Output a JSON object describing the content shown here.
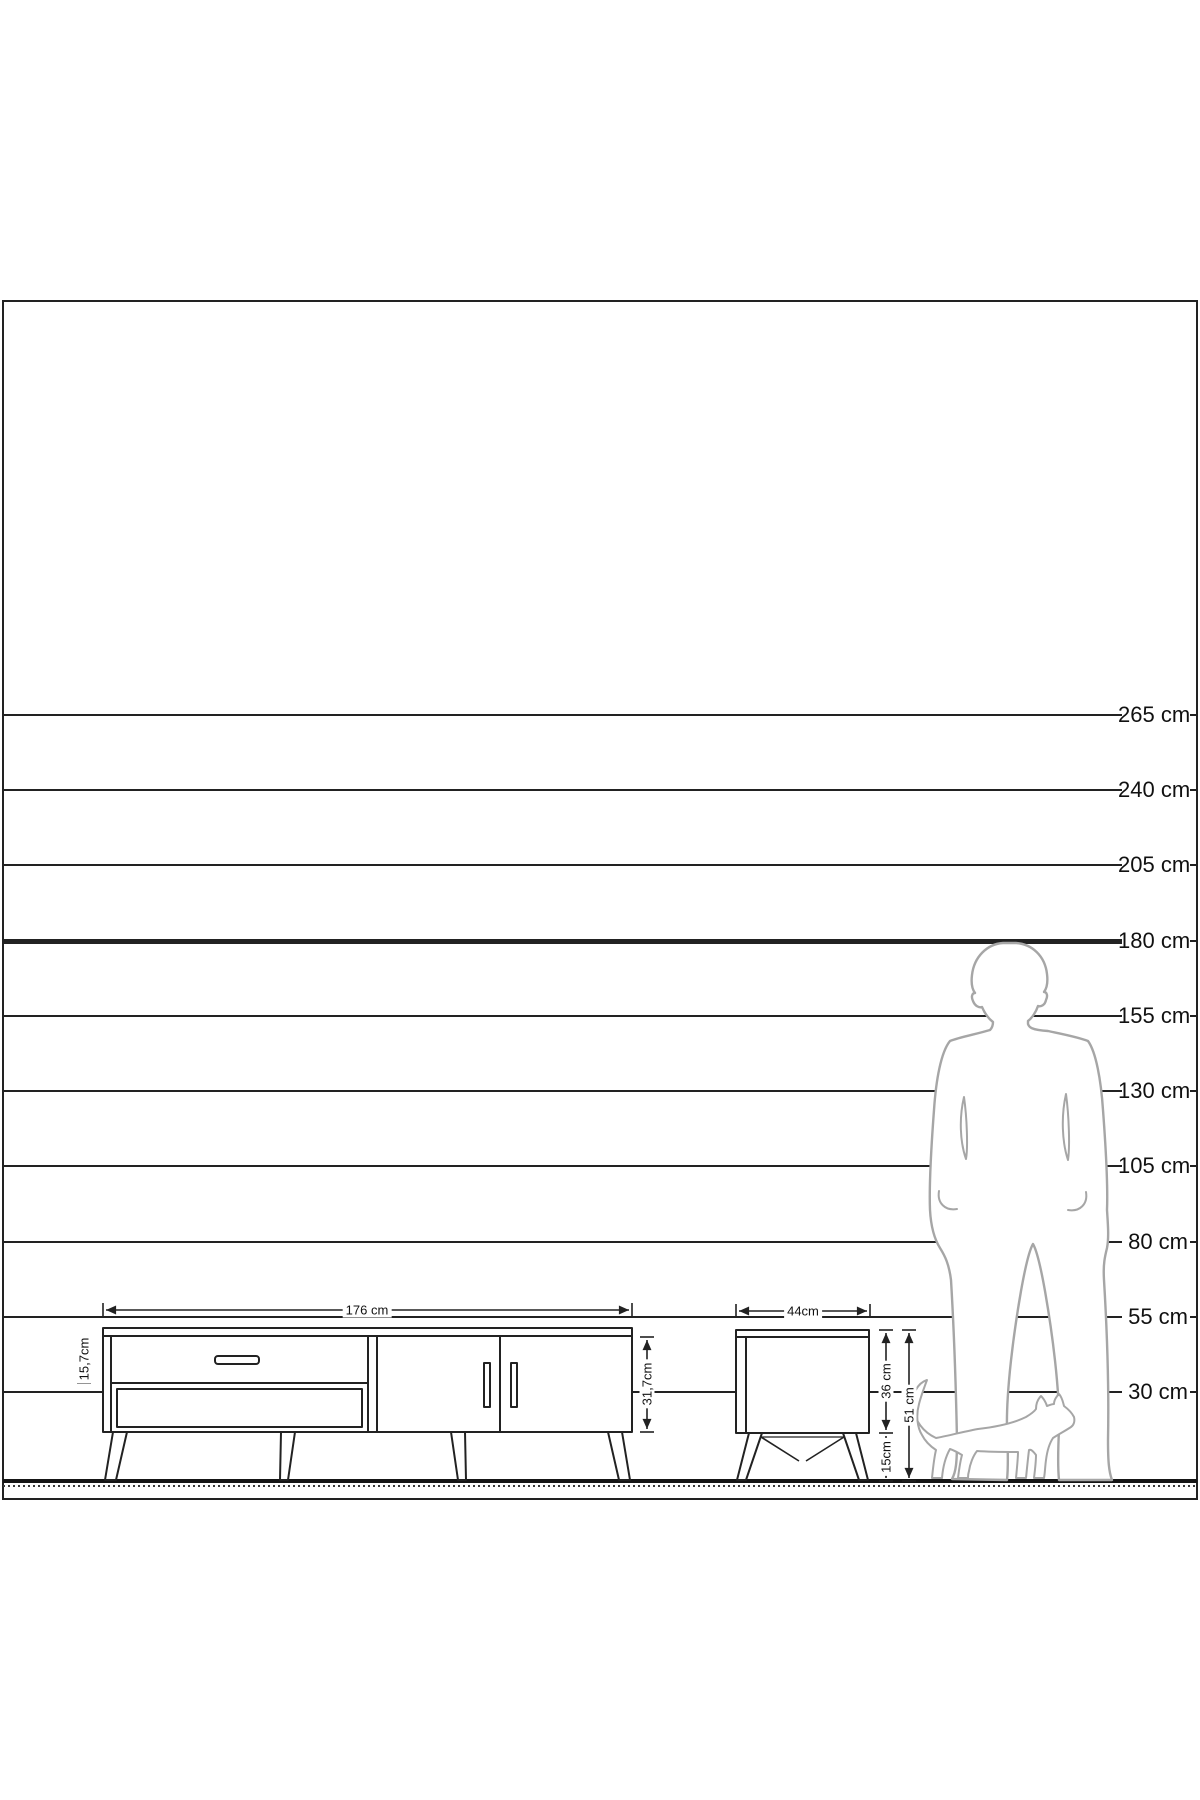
{
  "scale": {
    "labels": [
      "265 cm",
      "240 cm",
      "205 cm",
      "180 cm",
      "155 cm",
      "130 cm",
      "105 cm",
      "80 cm",
      "55 cm",
      "30 cm"
    ],
    "emphasized_label": "180 cm"
  },
  "tv_stand": {
    "width": "176 cm",
    "drawer_height": "15,7cm",
    "body_height": "31,7cm"
  },
  "side_table": {
    "width": "44cm",
    "body_height": "36 cm",
    "leg_height": "15cm",
    "total_height": "51 cm"
  },
  "icons": {
    "man": "man-silhouette",
    "cat": "cat-silhouette"
  },
  "colors": {
    "ink": "#222222",
    "silhouette": "#a6a6a6",
    "background": "#ffffff"
  }
}
